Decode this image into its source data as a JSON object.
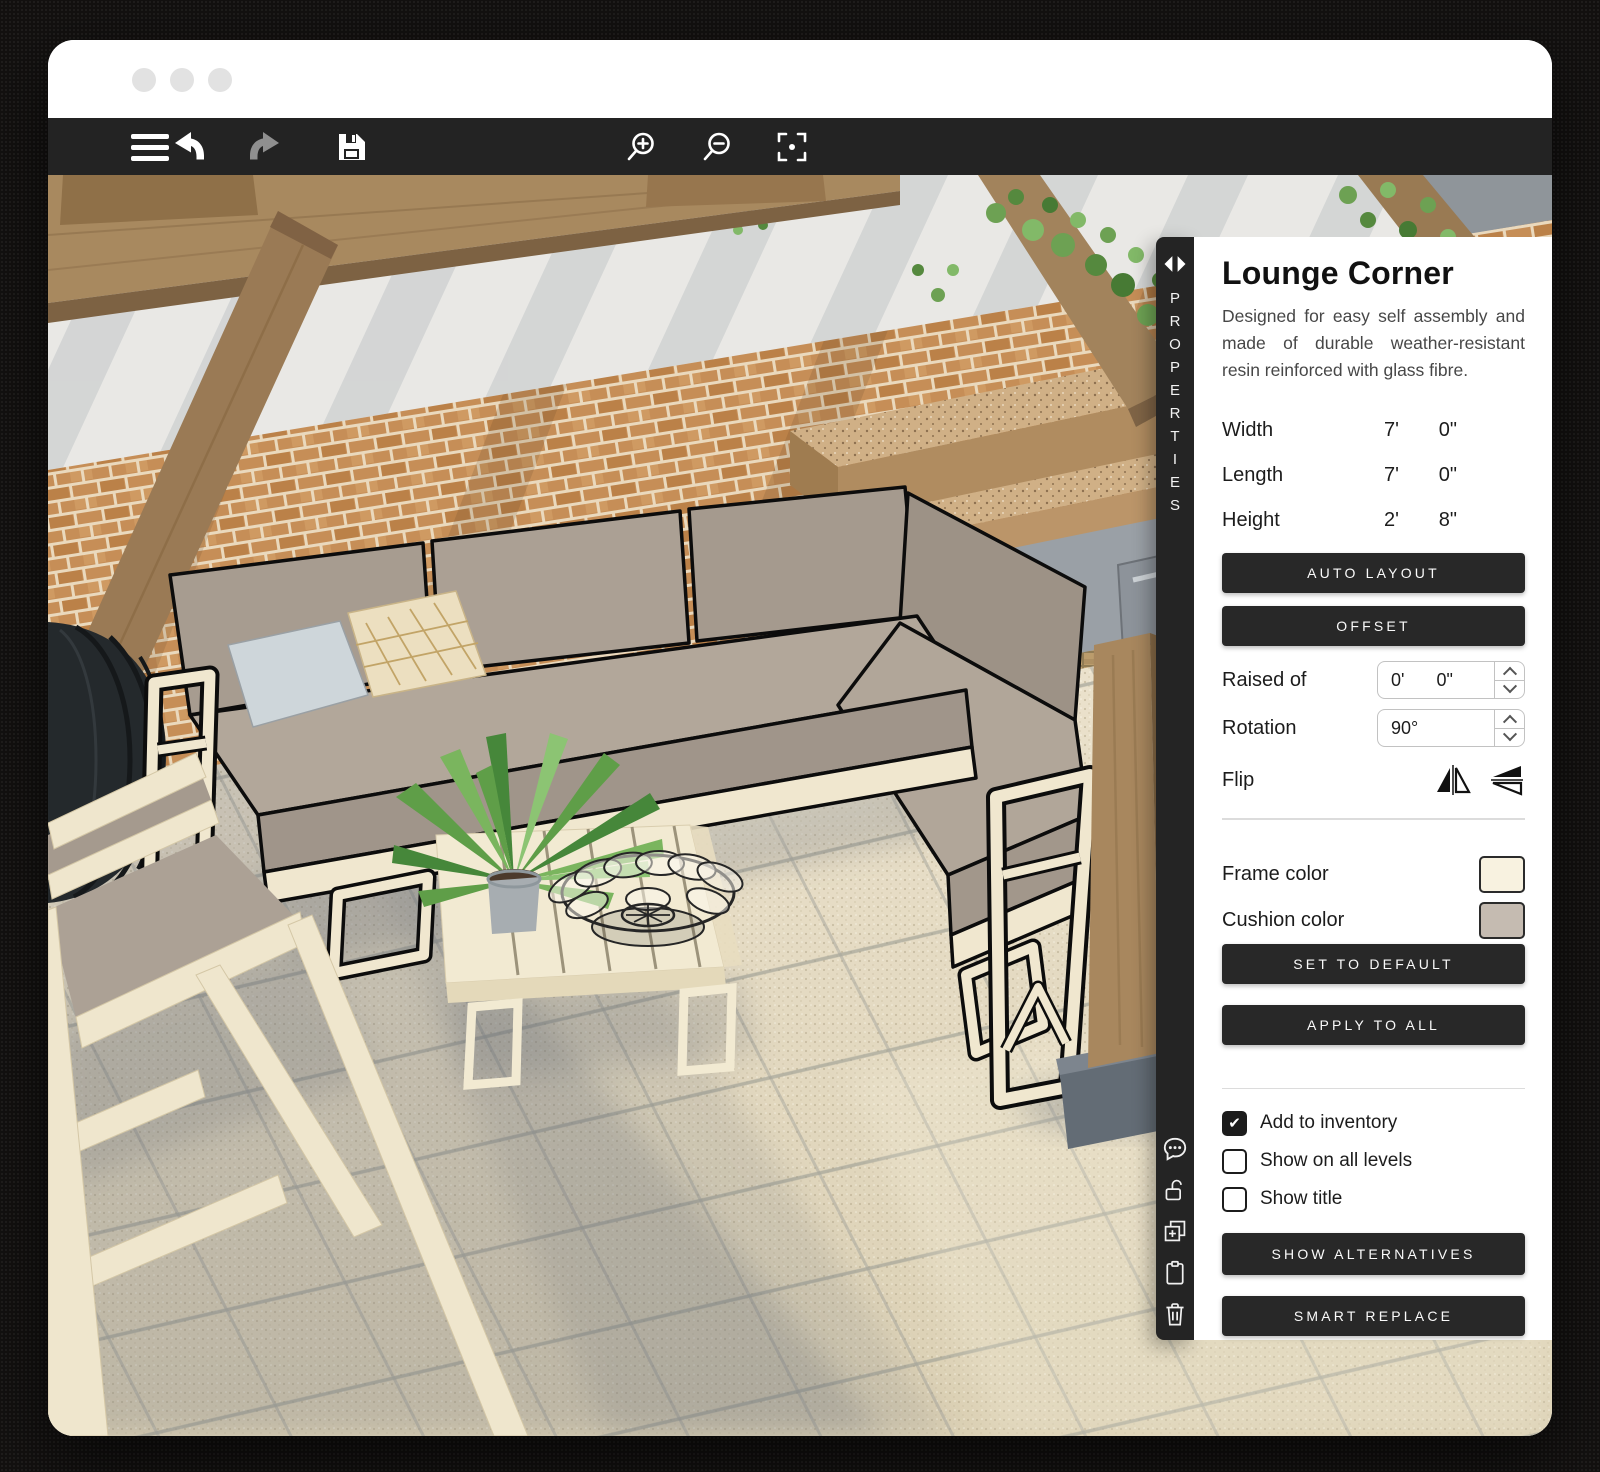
{
  "window_controls": {
    "dots": [
      "window-dot",
      "window-dot",
      "window-dot"
    ]
  },
  "toolbar": {
    "icons": [
      "menu",
      "undo",
      "redo",
      "save",
      "zoom-in",
      "zoom-out",
      "center-view"
    ]
  },
  "properties_strip": {
    "tab_label": "PROPERTIES",
    "icons": [
      "panel-collapse-arrows",
      "comments",
      "lock-open",
      "add-to-group",
      "clipboard",
      "trash"
    ]
  },
  "panel": {
    "title": "Lounge Corner",
    "description": "Designed for easy self assembly and made of durable weather-resistant resin reinforced with glass fibre.",
    "dimensions": [
      {
        "label": "Width",
        "feet": "7'",
        "inches": "0\""
      },
      {
        "label": "Length",
        "feet": "7'",
        "inches": "0\""
      },
      {
        "label": "Height",
        "feet": "2'",
        "inches": "8\""
      }
    ],
    "buttons": {
      "auto_layout": "AUTO LAYOUT",
      "offset": "OFFSET",
      "set_to_default": "SET TO DEFAULT",
      "apply_to_all": "APPLY TO ALL",
      "show_alternatives": "SHOW ALTERNATIVES",
      "smart_replace": "SMART REPLACE"
    },
    "raised_of": {
      "label": "Raised of",
      "feet": "0'",
      "inches": "0\""
    },
    "rotation": {
      "label": "Rotation",
      "value": "90°"
    },
    "flip": {
      "label": "Flip"
    },
    "colors": {
      "frame": {
        "label": "Frame color",
        "hex": "#f8f2e0"
      },
      "cushion": {
        "label": "Cushion color",
        "hex": "#c5bbb1"
      }
    },
    "checkboxes": [
      {
        "label": "Add to inventory",
        "checked": true
      },
      {
        "label": "Show on all levels",
        "checked": false
      },
      {
        "label": "Show title",
        "checked": false
      }
    ]
  },
  "scene_colors": {
    "floor": "#e2d8c2",
    "sofa_frame": "#f0e7cf",
    "sofa_cushion": "#a89d91",
    "brick": "#c68e57",
    "wood": "#a8895f"
  }
}
